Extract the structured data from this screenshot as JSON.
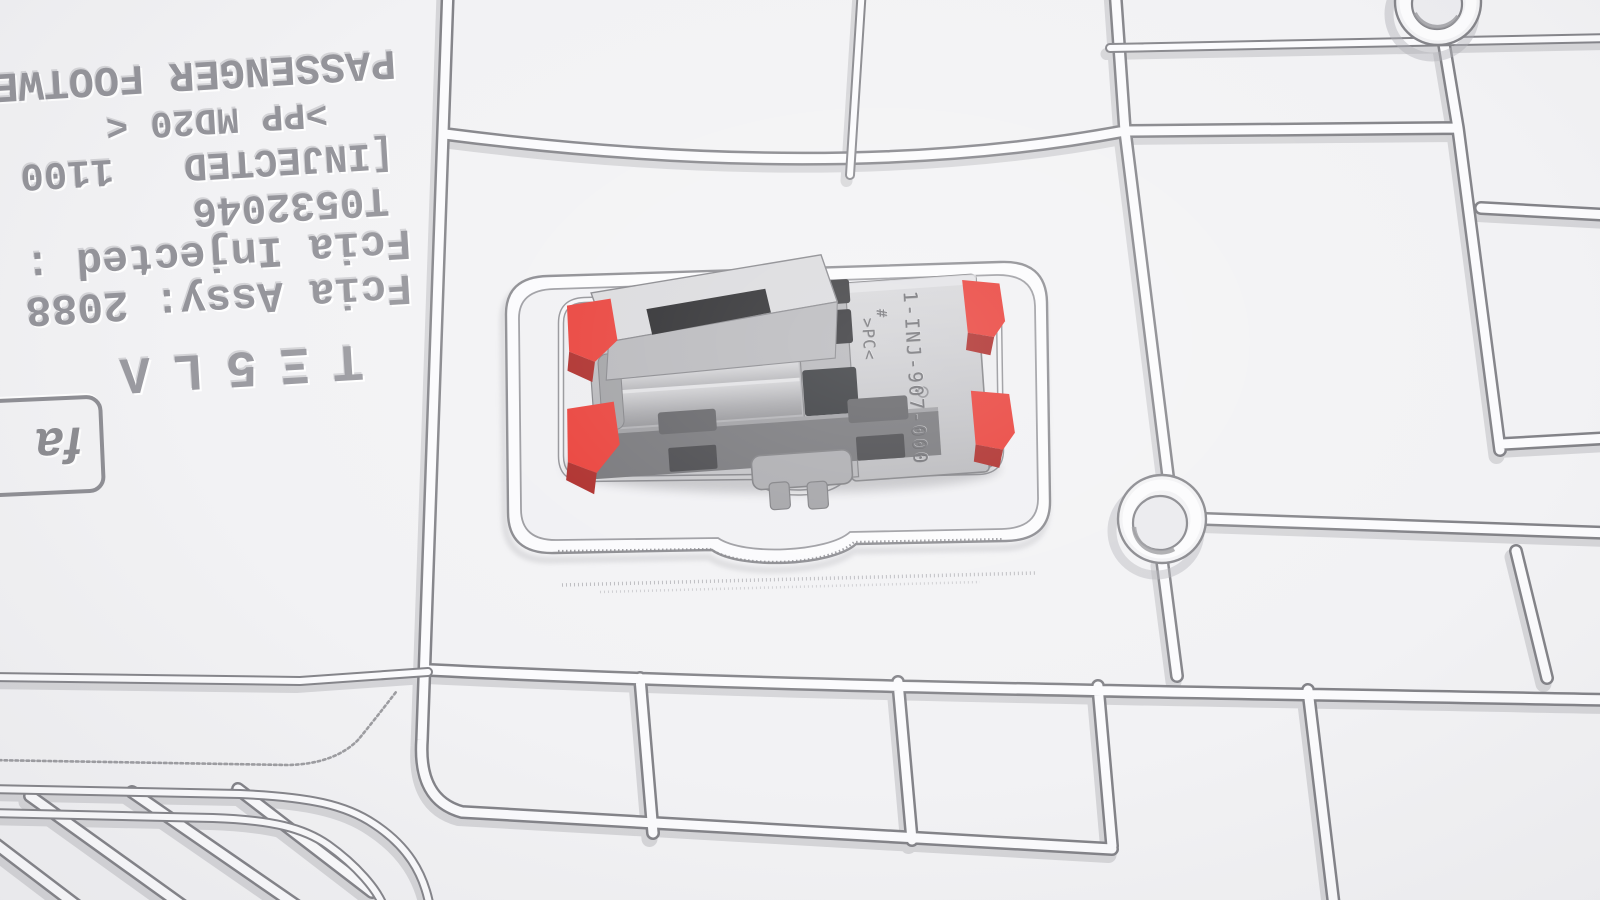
{
  "illustration": {
    "description": "White molded trim panel with rib network, screw bosses and an electrical connector highlighted with red retention clips"
  },
  "panel_markings": {
    "wordmark": "TΞ5LΛ",
    "assy_line": "Fcia Assy: 2088",
    "injected_line": "Fcia Injected :",
    "tool_number": "T0532046",
    "injected_bracket_line": "[INJECTED   1100",
    "material_line": ">PP MD20 <",
    "part_name_line": "PASSENGER FOOTWELL"
  },
  "supplier_badge": {
    "text": "fa"
  },
  "connector_markings": {
    "part_number": "1-INJ-907-000",
    "hash_mark": "#",
    "material_code": ">PC<"
  },
  "colors": {
    "panel": "#f2f2f4",
    "rib_line": "#85858a",
    "rib_core": "#fcfcfd",
    "highlight_red": "#e8342d",
    "highlight_red_dark": "#a81f1c",
    "connector_gray": "#b7b7bb",
    "connector_dark": "#2a2a2e",
    "engraving_gray": "#67676c"
  }
}
